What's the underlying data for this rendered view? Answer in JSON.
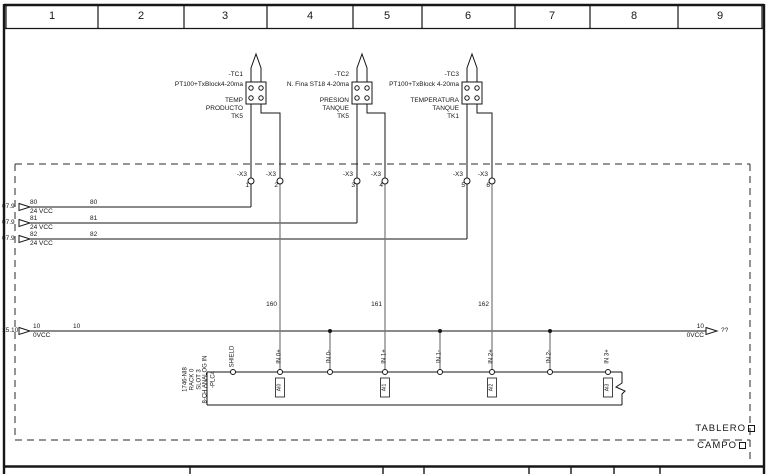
{
  "ruler": {
    "cells": [
      "1",
      "2",
      "3",
      "4",
      "5",
      "6",
      "7",
      "8",
      "9"
    ]
  },
  "field_devices": [
    {
      "tag": "-TC1",
      "type": "PT100+TxBlock4-20ma",
      "desc1": "TEMP",
      "desc2": "PRODUCTO",
      "desc3": "TK5"
    },
    {
      "tag": "-TC2",
      "type": "N. Fina ST18 4-20ma",
      "desc1": "PRESION",
      "desc2": "TANQUE",
      "desc3": "TK5"
    },
    {
      "tag": "-TC3",
      "type": "PT100+TxBlock 4-20ma",
      "desc1": "TEMPERATURA",
      "desc2": "TANQUE",
      "desc3": "TK1"
    }
  ],
  "terminal_strip": {
    "terminals": [
      {
        "name": "-X3",
        "num": "1"
      },
      {
        "name": "-X3",
        "num": "2"
      },
      {
        "name": "-X3",
        "num": "3"
      },
      {
        "name": "-X3",
        "num": "4"
      },
      {
        "name": "-X3",
        "num": "5"
      },
      {
        "name": "-X3",
        "num": "6"
      }
    ]
  },
  "supply_lines": [
    {
      "src": "07.9",
      "wire": "80",
      "volt": "24 VCC",
      "mid_wire": "80"
    },
    {
      "src": "07.9",
      "wire": "81",
      "volt": "24 VCC",
      "mid_wire": "81"
    },
    {
      "src": "07.9",
      "wire": "82",
      "volt": "24 VCC",
      "mid_wire": "82"
    }
  ],
  "common_line": {
    "src": "15.10",
    "wire": "10",
    "volt": "0VCC",
    "mid_wire": "10",
    "end_wire": "10",
    "end_volt": "0VCC",
    "dest": "??"
  },
  "cable_wires": [
    "160",
    "161",
    "162"
  ],
  "plc_module": {
    "part": "1746-NI8",
    "rack": "RACK 0",
    "slot": "SLOT 3",
    "io_type": "8-CH ANALOG IN",
    "tag": "-PLC4",
    "shield": "SHIELD",
    "inputs": [
      "IN 0+",
      "IN 0-",
      "IN 1+",
      "IN 1-",
      "IN 2+",
      "IN 2-",
      "IN 3+"
    ],
    "channel_marks": [
      "AI0",
      "AI1",
      "AI2",
      "AI3"
    ]
  },
  "zones": {
    "panel": "TABLERO",
    "field": "CAMPO"
  }
}
